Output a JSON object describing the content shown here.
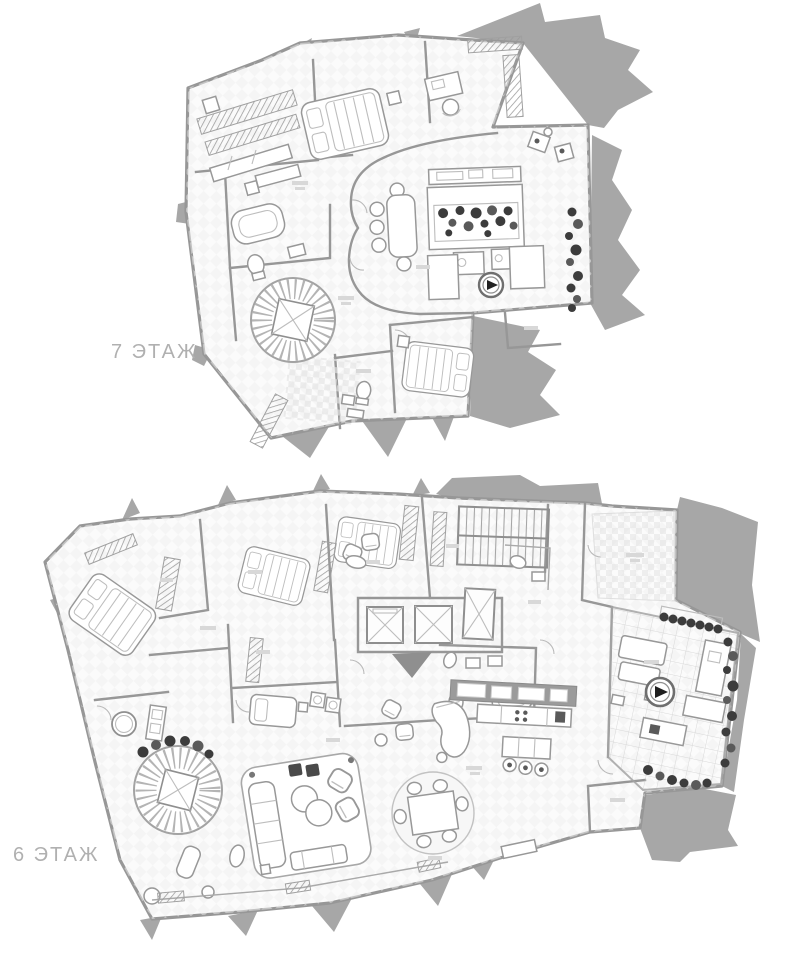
{
  "floors": [
    {
      "id": "floor-7",
      "label": "7 ЭТАЖ"
    },
    {
      "id": "floor-6",
      "label": "6 ЭТАЖ"
    }
  ],
  "colors": {
    "background": "#ffffff",
    "mass": "#a7a7a7",
    "wall": "#979797",
    "line": "#adadad",
    "plant": "#3c3c3c",
    "label": "#b0b0b0",
    "floor": "#fbfbfb"
  },
  "features": {
    "floor7": [
      "wardrobe-closets",
      "master-bed",
      "office-desk-chair",
      "radiators",
      "oval-living-dining-room",
      "dining-table-six-seats",
      "kitchen-island-with-plants",
      "cooktop-circle",
      "terrace-plant-row",
      "spiral-staircase",
      "second-bedroom-bed",
      "bathroom-tub",
      "toilet",
      "checker-tiled-bath",
      "balcony-railing"
    ],
    "floor6": [
      "bedroom-bed-1",
      "bedroom-bed-2",
      "bedroom-bed-3",
      "wardrobe-closets",
      "switchback-staircase",
      "elevator-1",
      "elevator-2",
      "elevator-3",
      "entry-arrow",
      "checker-terrace",
      "tiled-kitchen-terrace",
      "fire-pit-circle",
      "planter-row",
      "lounge-furniture",
      "kitchen-upper-cabinets",
      "kitchen-counter",
      "kitchen-island-stools",
      "grand-piano",
      "armchairs",
      "washer-dryer",
      "daybed",
      "round-bathtub",
      "spiral-staircase-with-shaft",
      "living-rug-sofa-set",
      "round-dining-set",
      "chaise-lounge",
      "balcony-railing"
    ]
  }
}
